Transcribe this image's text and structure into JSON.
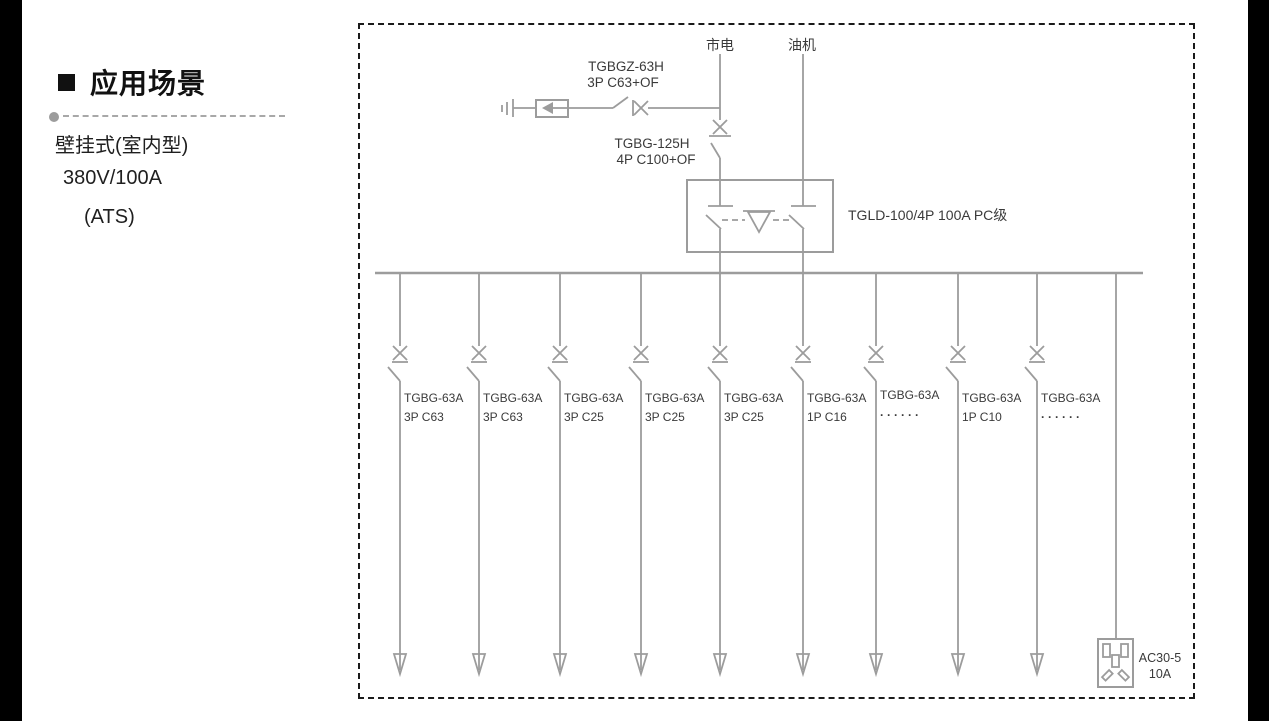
{
  "sidebar": {
    "title": "应用场景",
    "subtitle_lines": [
      "壁挂式(室内型)",
      "380V/100A",
      "(ATS)"
    ]
  },
  "diagram": {
    "sources": {
      "mains": "市电",
      "generator": "油机"
    },
    "spd_breaker": {
      "model": "TGBGZ-63H",
      "spec": "3P C63+OF"
    },
    "main_breaker": {
      "model": "TGBG-125H",
      "spec": "4P C100+OF"
    },
    "ats": {
      "label": "TGLD-100/4P 100A PC级"
    },
    "branches": [
      {
        "model": "TGBG-63A",
        "spec": "3P C63"
      },
      {
        "model": "TGBG-63A",
        "spec": "3P C63"
      },
      {
        "model": "TGBG-63A",
        "spec": "3P C25"
      },
      {
        "model": "TGBG-63A",
        "spec": "3P C25"
      },
      {
        "model": "TGBG-63A",
        "spec": "3P C25"
      },
      {
        "model": "TGBG-63A",
        "spec": "1P C16"
      },
      {
        "model": "TGBG-63A",
        "spec": "······"
      },
      {
        "model": "TGBG-63A",
        "spec": "1P C10"
      },
      {
        "model": "TGBG-63A",
        "spec": "······"
      }
    ],
    "socket": {
      "model": "AC30-5",
      "rating": "10A"
    }
  },
  "colors": {
    "line": "#9c9c9c",
    "diagram_text": "#3a3a3a",
    "border": "#1a1a1a",
    "sidebar_text": "#1f1f1f"
  }
}
